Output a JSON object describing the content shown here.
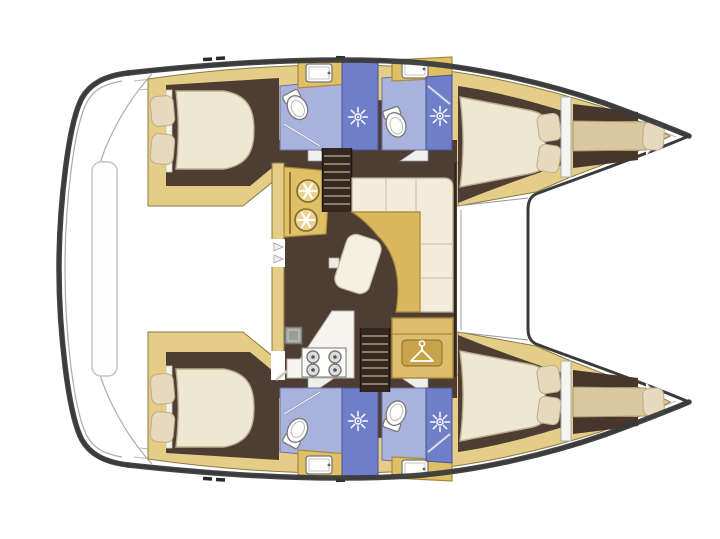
{
  "diagram": {
    "type": "catamaran-floor-plan",
    "view": "top-down interior layout, bows pointing right",
    "visible_text": [],
    "vessel": {
      "hulls": 2,
      "double_cabins": 4,
      "bathrooms": 4,
      "forepeak_berths": 2,
      "salons": 1
    },
    "rooms": {
      "salon": {
        "label": "Central salon with galley, dinette and chart area"
      },
      "cockpit": {
        "label": "Aft cockpit deck with bench"
      },
      "foredeck": {
        "label": "Foredeck between hulls"
      },
      "port_aft_cabin": {
        "label": "Port aft double cabin",
        "pillows": 2
      },
      "port_aft_bathroom": {
        "label": "Port aft bathroom with toilet, sink and shower"
      },
      "port_fwd_bathroom": {
        "label": "Port forward bathroom with toilet, sink and shower"
      },
      "port_fwd_cabin": {
        "label": "Port forward double cabin",
        "pillows": 2
      },
      "port_forepeak": {
        "label": "Port forepeak berth",
        "pillows": 1
      },
      "stbd_aft_cabin": {
        "label": "Starboard aft double cabin",
        "pillows": 2
      },
      "stbd_aft_bathroom": {
        "label": "Starboard aft bathroom with toilet, sink and shower"
      },
      "stbd_fwd_bathroom": {
        "label": "Starboard forward bathroom with toilet, sink and shower"
      },
      "stbd_fwd_cabin": {
        "label": "Starboard forward double cabin",
        "pillows": 2
      },
      "stbd_forepeak": {
        "label": "Starboard forepeak berth",
        "pillows": 1
      }
    },
    "salon_features": {
      "galley_sinks": {
        "label": "Twin round galley sinks on aft counter",
        "count": 2
      },
      "stove": {
        "label": "Four-burner stove on galley counter",
        "burners": 4
      },
      "oven": {
        "label": "Oven / appliance box"
      },
      "sofa": {
        "label": "L-shaped dinette sofa"
      },
      "table": {
        "label": "Curved dinette table"
      },
      "stool": {
        "label": "Movable bench / stool"
      },
      "wardrobe": {
        "label": "Wardrobe locker with hanger symbol"
      },
      "stairs_port": {
        "label": "Companionway steps down to port hull"
      },
      "stairs_stbd": {
        "label": "Companionway steps down to starboard hull"
      },
      "doors": {
        "label": "Sliding door openings to cockpit"
      }
    },
    "icons": {
      "shower_head": {
        "glyph": "white starburst",
        "count": 4
      },
      "toilet": {
        "glyph": "white bowl with tank",
        "count": 4
      },
      "sink": {
        "glyph": "white rounded basin",
        "count": 4
      },
      "galley_sink_drain": {
        "glyph": "white asterisk in circle",
        "count": 2
      },
      "hanger": {
        "glyph": "white clothes hanger",
        "count": 1
      },
      "burner": {
        "glyph": "grey ring",
        "count": 4
      }
    },
    "colors": {
      "outline": "#3b3b3b",
      "hull_trim": "#e4cd86",
      "floor_brown": "#4e3d33",
      "stairs_brown": "#35291f",
      "bathroom_floor": "#a9b2dd",
      "shower_floor": "#6f7ec9",
      "mattress": "#efe7d2",
      "pillow": "#e6d9bd",
      "berth_tan": "#d9c89f",
      "sofa_cream": "#f2ecd8",
      "table_gold": "#d9b85f",
      "counter_gold": "#dfc067",
      "wardrobe_gold": "#dcbd6b",
      "galley_white": "#f6f4ee",
      "deck_line": "#b9b9b9",
      "background": "#ffffff"
    }
  }
}
